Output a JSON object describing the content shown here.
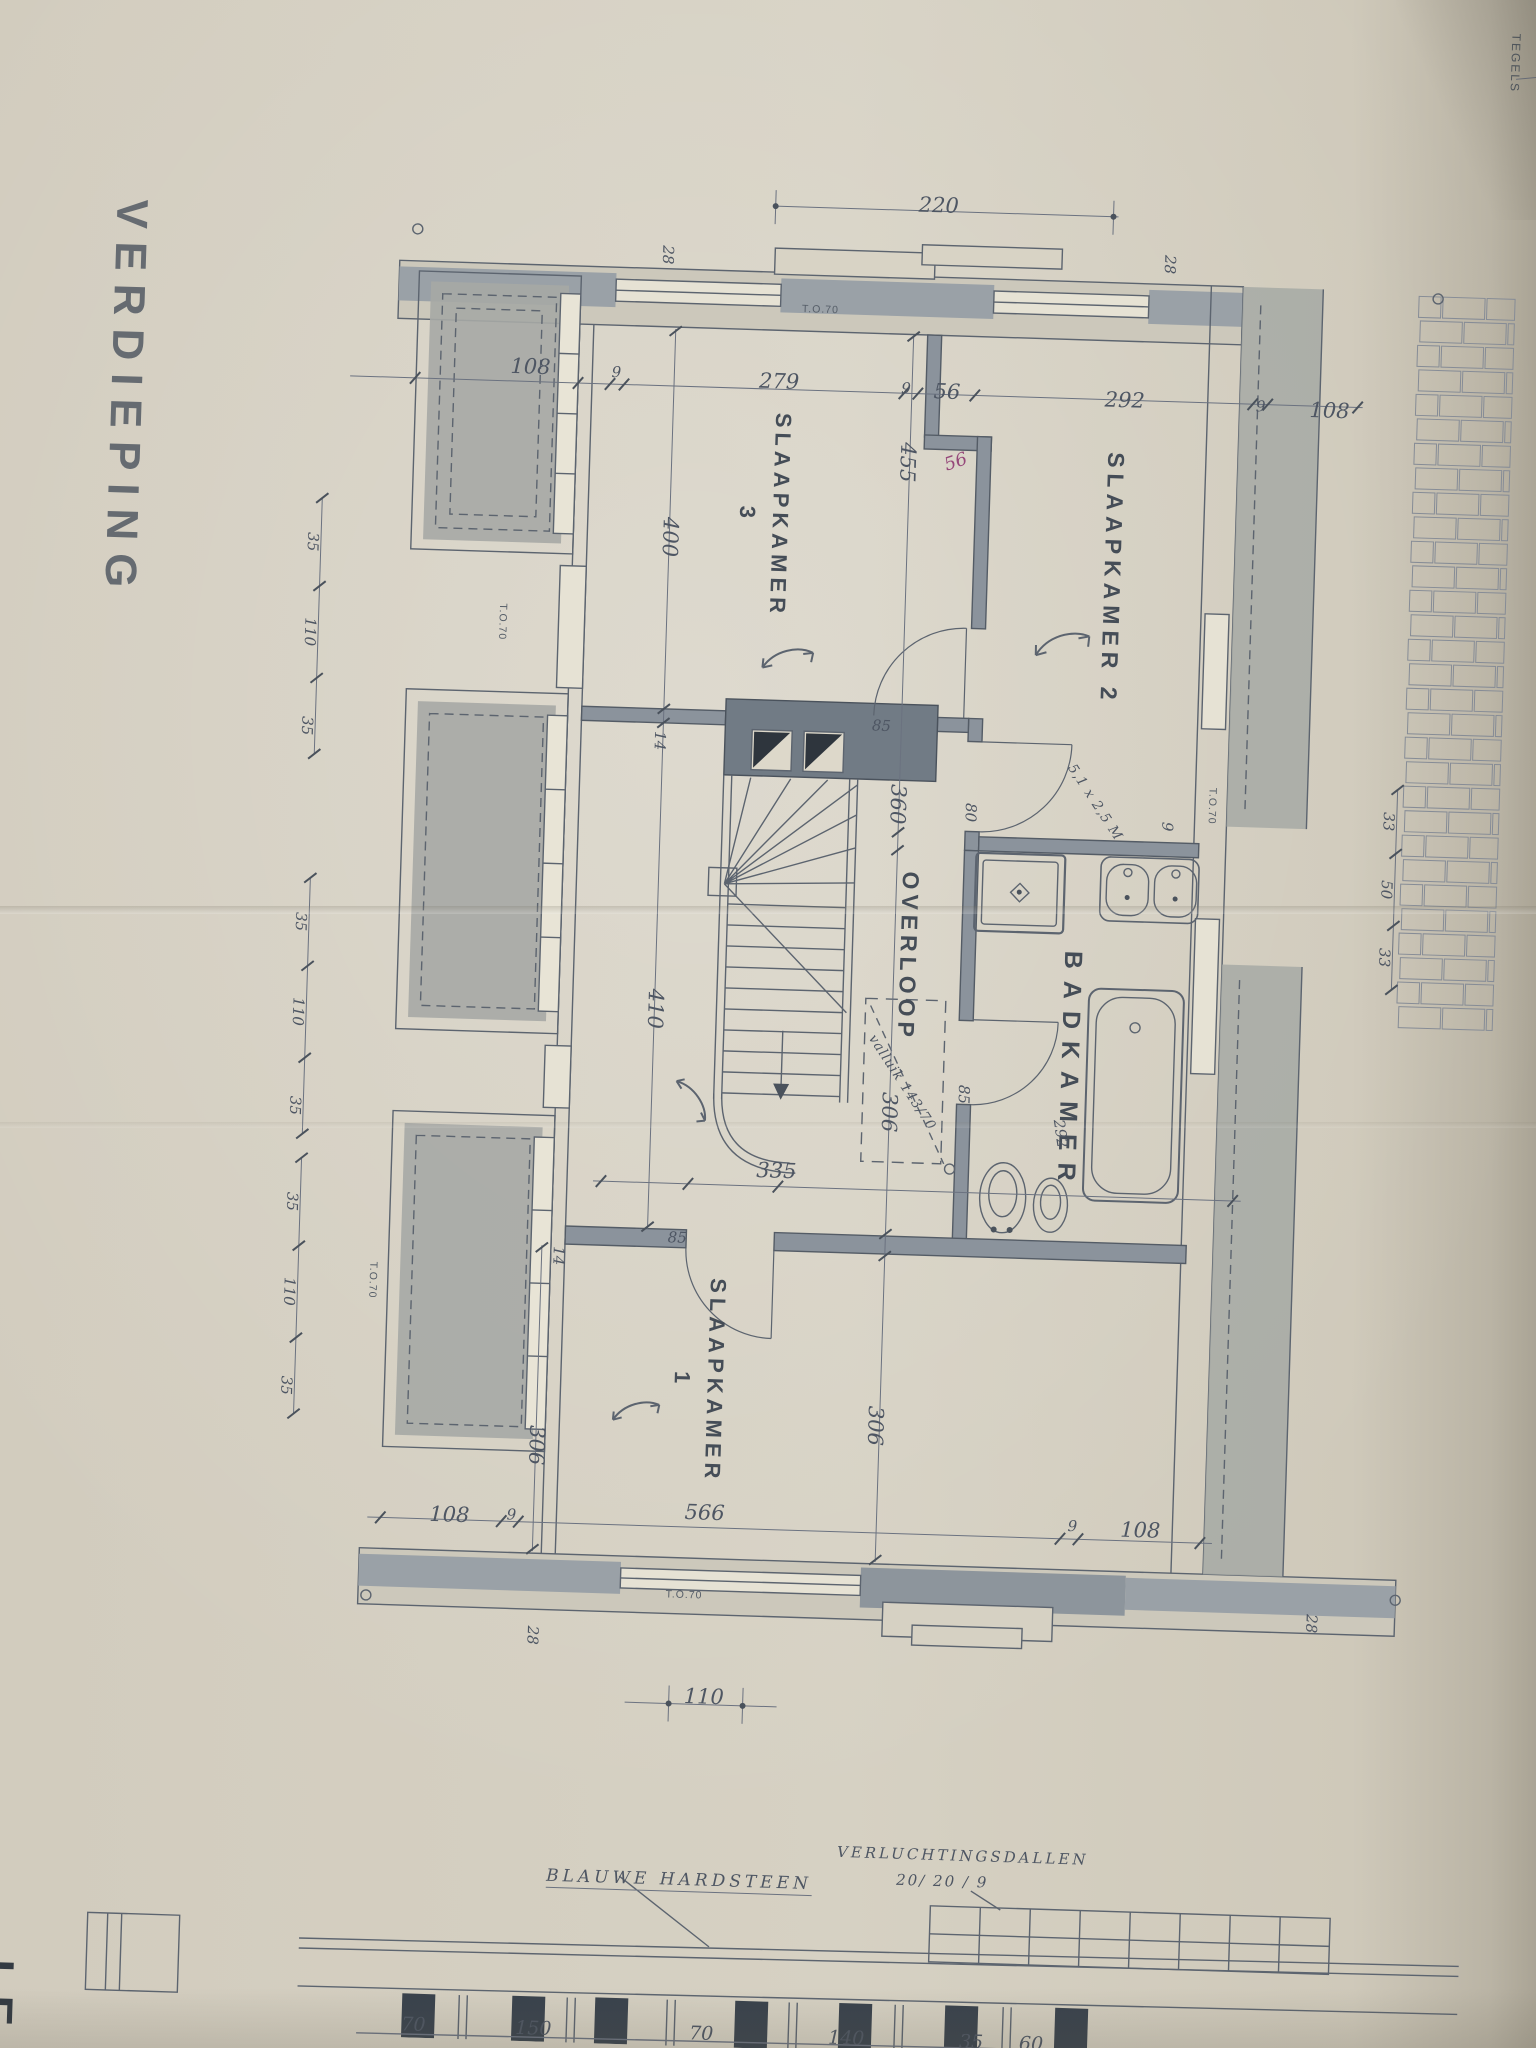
{
  "title": "VERDIEPING",
  "corner_note": "TEGELS",
  "accent_colors": {
    "ink": "#5c646f",
    "wall_fill": "#8b939c",
    "roof_hatch": "#a6a9a5",
    "paper": "#d3cec0",
    "red_note": "#96487a"
  },
  "rooms": [
    {
      "name": "slaapkamer-2",
      "lines": [
        "SLAAPKAMER  2"
      ],
      "x": 1100,
      "y": 568,
      "fs": 23,
      "ls": 6
    },
    {
      "name": "slaapkamer-3",
      "lines": [
        "SLAAPKAMER",
        "3"
      ],
      "x": 750,
      "y": 515,
      "fs": 22,
      "ls": 5
    },
    {
      "name": "slaapkamer-1",
      "lines": [
        "SLAAPKAMER",
        "1"
      ],
      "x": 712,
      "y": 1382,
      "fs": 22,
      "ls": 5
    },
    {
      "name": "overloop",
      "lines": [
        "OVERLOOP"
      ],
      "x": 908,
      "y": 952,
      "fs": 23,
      "ls": 5
    },
    {
      "name": "badkamer",
      "lines": [
        "BADKAMER"
      ],
      "x": 1072,
      "y": 1062,
      "fs": 25,
      "ls": 12
    }
  ],
  "labels": [
    {
      "t": "220",
      "x": 915,
      "y": 200,
      "r": 0,
      "c": "hand",
      "n": "dim-220"
    },
    {
      "t": "28",
      "x": 646,
      "y": 258,
      "r": 90,
      "c": "hand-sm",
      "n": "dim-28"
    },
    {
      "t": "28",
      "x": 1148,
      "y": 252,
      "r": 90,
      "c": "hand-sm",
      "n": "dim-28"
    },
    {
      "t": "108",
      "x": 512,
      "y": 374,
      "r": 0,
      "c": "hand",
      "n": "dim-108"
    },
    {
      "t": "9",
      "x": 598,
      "y": 377,
      "r": 0,
      "c": "hand-sm",
      "n": "dim-9"
    },
    {
      "t": "279",
      "x": 761,
      "y": 381,
      "r": 0,
      "c": "hand",
      "n": "dim-279"
    },
    {
      "t": "9",
      "x": 888,
      "y": 384,
      "r": 0,
      "c": "hand-sm",
      "n": "dim-9"
    },
    {
      "t": "56",
      "x": 929,
      "y": 386,
      "r": 0,
      "c": "hand",
      "n": "dim-56"
    },
    {
      "t": "292",
      "x": 1107,
      "y": 389,
      "r": 0,
      "c": "hand",
      "n": "dim-292"
    },
    {
      "t": "9",
      "x": 1243,
      "y": 391,
      "r": 0,
      "c": "hand-sm",
      "n": "dim-9"
    },
    {
      "t": "108",
      "x": 1312,
      "y": 393,
      "r": 0,
      "c": "hand",
      "n": "dim-108"
    },
    {
      "t": "56",
      "x": 940,
      "y": 456,
      "r": -20,
      "c": "hand-red",
      "n": "note-56-red"
    },
    {
      "t": "T.O.70",
      "x": 800,
      "y": 308,
      "r": 0,
      "c": "tiny",
      "n": "window-note"
    },
    {
      "t": "400",
      "x": 657,
      "y": 540,
      "r": 90,
      "c": "hand",
      "n": "dim-400"
    },
    {
      "t": "455",
      "x": 892,
      "y": 458,
      "r": 90,
      "c": "hand",
      "n": "dim-455"
    },
    {
      "t": "360",
      "x": 893,
      "y": 800,
      "r": 90,
      "c": "hand",
      "n": "dim-360"
    },
    {
      "t": "306",
      "x": 894,
      "y": 1108,
      "r": 90,
      "c": "hand",
      "n": "dim-306"
    },
    {
      "t": "306",
      "x": 890,
      "y": 1422,
      "r": 90,
      "c": "hand",
      "n": "dim-306"
    },
    {
      "t": "306",
      "x": 552,
      "y": 1452,
      "r": 90,
      "c": "hand",
      "n": "dim-306"
    },
    {
      "t": "410",
      "x": 657,
      "y": 1012,
      "r": 90,
      "c": "hand",
      "n": "dim-410"
    },
    {
      "t": "14",
      "x": 653,
      "y": 744,
      "r": 90,
      "c": "hand-sm",
      "n": "dim-14"
    },
    {
      "t": "14",
      "x": 568,
      "y": 1262,
      "r": 90,
      "c": "hand-sm",
      "n": "dim-14"
    },
    {
      "t": "85",
      "x": 874,
      "y": 722,
      "r": 0,
      "c": "hand-sm",
      "n": "door-85"
    },
    {
      "t": "80",
      "x": 966,
      "y": 806,
      "r": 90,
      "c": "hand-sm",
      "n": "door-80"
    },
    {
      "t": "85",
      "x": 968,
      "y": 1088,
      "r": 90,
      "c": "hand-sm",
      "n": "door-85"
    },
    {
      "t": "85",
      "x": 686,
      "y": 1240,
      "r": 0,
      "c": "hand-sm",
      "n": "door-85"
    },
    {
      "t": "9",
      "x": 1163,
      "y": 814,
      "r": 90,
      "c": "hand-sm",
      "n": "dim-9"
    },
    {
      "t": "335",
      "x": 783,
      "y": 1170,
      "r": 0,
      "c": "hand",
      "n": "dim-335"
    },
    {
      "t": "valluik 143/70",
      "x": 906,
      "y": 1078,
      "r": 55,
      "c": "hand-script",
      "n": "note-valluik"
    },
    {
      "t": "292",
      "x": 1066,
      "y": 1124,
      "r": 80,
      "c": "hand-sm",
      "n": "dim-292-hand"
    },
    {
      "t": "5,1 x 2,5 M",
      "x": 1090,
      "y": 792,
      "r": 55,
      "c": "hand-script",
      "n": "note-area"
    },
    {
      "t": "T.O.70",
      "x": 492,
      "y": 630,
      "r": 90,
      "c": "tiny",
      "n": "window-note"
    },
    {
      "t": "T.O.70",
      "x": 383,
      "y": 1292,
      "r": 90,
      "c": "tiny",
      "n": "window-note"
    },
    {
      "t": "T.O.70",
      "x": 1207,
      "y": 792,
      "r": 90,
      "c": "tiny",
      "n": "window-note"
    },
    {
      "t": "T.O.70",
      "x": 704,
      "y": 1597,
      "r": 0,
      "c": "tiny",
      "n": "window-note"
    },
    {
      "t": "108",
      "x": 467,
      "y": 1524,
      "r": 0,
      "c": "hand",
      "n": "dim-108"
    },
    {
      "t": "9",
      "x": 529,
      "y": 1522,
      "r": 0,
      "c": "hand-sm",
      "n": "dim-9"
    },
    {
      "t": "566",
      "x": 722,
      "y": 1514,
      "r": 0,
      "c": "hand",
      "n": "dim-566"
    },
    {
      "t": "9",
      "x": 1090,
      "y": 1516,
      "r": 0,
      "c": "hand-sm",
      "n": "dim-9"
    },
    {
      "t": "108",
      "x": 1158,
      "y": 1518,
      "r": 0,
      "c": "hand",
      "n": "dim-108"
    },
    {
      "t": "28",
      "x": 554,
      "y": 1642,
      "r": 90,
      "c": "hand-sm",
      "n": "dim-28"
    },
    {
      "t": "28",
      "x": 1332,
      "y": 1606,
      "r": 90,
      "c": "hand-sm",
      "n": "dim-28"
    },
    {
      "t": "110",
      "x": 727,
      "y": 1698,
      "r": 0,
      "c": "hand",
      "n": "dim-110"
    },
    {
      "t": "35",
      "x": 300,
      "y": 556,
      "r": 90,
      "c": "hand-sm",
      "n": "dim-35"
    },
    {
      "t": "110",
      "x": 300,
      "y": 646,
      "r": 90,
      "c": "hand-sm",
      "n": "dim-110"
    },
    {
      "t": "35",
      "x": 300,
      "y": 740,
      "r": 90,
      "c": "hand-sm",
      "n": "dim-35"
    },
    {
      "t": "35",
      "x": 300,
      "y": 936,
      "r": 90,
      "c": "hand-sm",
      "n": "dim-35"
    },
    {
      "t": "110",
      "x": 300,
      "y": 1026,
      "r": 90,
      "c": "hand-sm",
      "n": "dim-110"
    },
    {
      "t": "35",
      "x": 300,
      "y": 1120,
      "r": 90,
      "c": "hand-sm",
      "n": "dim-35"
    },
    {
      "t": "35",
      "x": 300,
      "y": 1216,
      "r": 90,
      "c": "hand-sm",
      "n": "dim-35"
    },
    {
      "t": "110",
      "x": 300,
      "y": 1306,
      "r": 90,
      "c": "hand-sm",
      "n": "dim-110"
    },
    {
      "t": "35",
      "x": 300,
      "y": 1400,
      "r": 90,
      "c": "hand-sm",
      "n": "dim-35"
    },
    {
      "t": "33",
      "x": 1384,
      "y": 802,
      "r": 90,
      "c": "hand-sm",
      "n": "dim-33"
    },
    {
      "t": "50",
      "x": 1384,
      "y": 870,
      "r": 90,
      "c": "hand-sm",
      "n": "dim-50"
    },
    {
      "t": "33",
      "x": 1384,
      "y": 938,
      "r": 90,
      "c": "hand-sm",
      "n": "dim-33"
    }
  ],
  "footer": {
    "blauwe_hardsteen": "BLAUWE  HARDSTEEN",
    "verluchtingsdallen": "VERLUCHTINGSDALLEN",
    "verluchtingsdallen_size": "20/ 20 / 9",
    "legend_partial": "LE",
    "dims": [
      {
        "t": "70",
        "x": 447
      },
      {
        "t": "150",
        "x": 567
      },
      {
        "t": "70",
        "x": 735
      },
      {
        "t": "140",
        "x": 880
      },
      {
        "t": "35",
        "x": 1005
      },
      {
        "t": "60",
        "x": 1065
      }
    ]
  }
}
